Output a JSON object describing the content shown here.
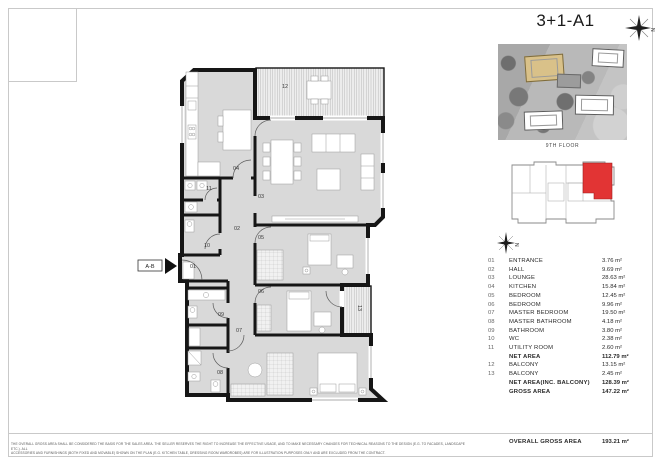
{
  "page": {
    "title": "3+1-A1",
    "floor_label": "9TH FLOOR",
    "section_marker_label": "A-B",
    "compass_letter": "N",
    "disclaimer_line1": "THE OVERALL GROSS AREA SHALL BE CONSIDERED THE BASIS FOR THE SALES AREA. THE SELLER RESERVES THE RIGHT TO INCREASE THE EFFECTIVE USAGE, AND TO MAKE NECESSARY CHANGES FOR TECHNICAL REASONS TO THE DESIGN (E.G. TO FACADES, LANDSCAPE ETC.). ALL",
    "disclaimer_line2": "ACCESSORIES AND FURNISHINGS (BOTH FIXED AND MOVABLE) SHOWN ON THE PLAN (E.G. KITCHEN TABLE, DRESSING ROOM WARDROBES) ARE FOR ILLUSTRATION PURPOSES ONLY AND ARE EXCLUDED FROM THE CONTRACT."
  },
  "legend": {
    "rows": [
      {
        "no": "01",
        "name": "ENTRANCE",
        "area": "3.76 m²",
        "bold": false
      },
      {
        "no": "02",
        "name": "HALL",
        "area": "9.69 m²",
        "bold": false
      },
      {
        "no": "03",
        "name": "LOUNGE",
        "area": "28.63 m²",
        "bold": false
      },
      {
        "no": "04",
        "name": "KITCHEN",
        "area": "15.84 m²",
        "bold": false
      },
      {
        "no": "05",
        "name": "BEDROOM",
        "area": "12.45 m²",
        "bold": false
      },
      {
        "no": "06",
        "name": "BEDROOM",
        "area": "9.96 m²",
        "bold": false
      },
      {
        "no": "07",
        "name": "MASTER BEDROOM",
        "area": "19.50 m²",
        "bold": false
      },
      {
        "no": "08",
        "name": "MASTER BATHROOM",
        "area": "4.18 m²",
        "bold": false
      },
      {
        "no": "09",
        "name": "BATHROOM",
        "area": "3.80 m²",
        "bold": false
      },
      {
        "no": "10",
        "name": "WC",
        "area": "2.38 m²",
        "bold": false
      },
      {
        "no": "11",
        "name": "UTILITY ROOM",
        "area": "2.60 m²",
        "bold": false
      },
      {
        "no": "",
        "name": "NET AREA",
        "area": "112.79 m²",
        "bold": true
      },
      {
        "no": "12",
        "name": "BALCONY",
        "area": "13.15 m²",
        "bold": false
      },
      {
        "no": "13",
        "name": "BALCONY",
        "area": "2.45 m²",
        "bold": false
      },
      {
        "no": "",
        "name": "NET AREA(INC. BALCONY)",
        "area": "128.39 m²",
        "bold": true
      },
      {
        "no": "",
        "name": "GROSS AREA",
        "area": "147.22 m²",
        "bold": true
      }
    ],
    "overall_row": {
      "no": "",
      "name": "OVERALL GROSS AREA",
      "area": "193.21 m²"
    }
  },
  "plan": {
    "room_labels": [
      {
        "no": "01",
        "x": 68,
        "y": 220
      },
      {
        "no": "02",
        "x": 112,
        "y": 182
      },
      {
        "no": "03",
        "x": 136,
        "y": 150
      },
      {
        "no": "04",
        "x": 111,
        "y": 122
      },
      {
        "no": "05",
        "x": 136,
        "y": 191
      },
      {
        "no": "06",
        "x": 136,
        "y": 245
      },
      {
        "no": "07",
        "x": 114,
        "y": 284
      },
      {
        "no": "08",
        "x": 95,
        "y": 326
      },
      {
        "no": "09",
        "x": 96,
        "y": 268
      },
      {
        "no": "10",
        "x": 82,
        "y": 199
      },
      {
        "no": "11",
        "x": 84,
        "y": 142
      },
      {
        "no": "12",
        "x": 160,
        "y": 40
      },
      {
        "no": "13",
        "x": 233,
        "y": 260,
        "rotate": 90
      }
    ]
  },
  "colors": {
    "wall": "#161616",
    "room_fill": "#d9d9d9",
    "unit_highlight": "#e23434",
    "site_building_highlight": "#d9c189"
  }
}
